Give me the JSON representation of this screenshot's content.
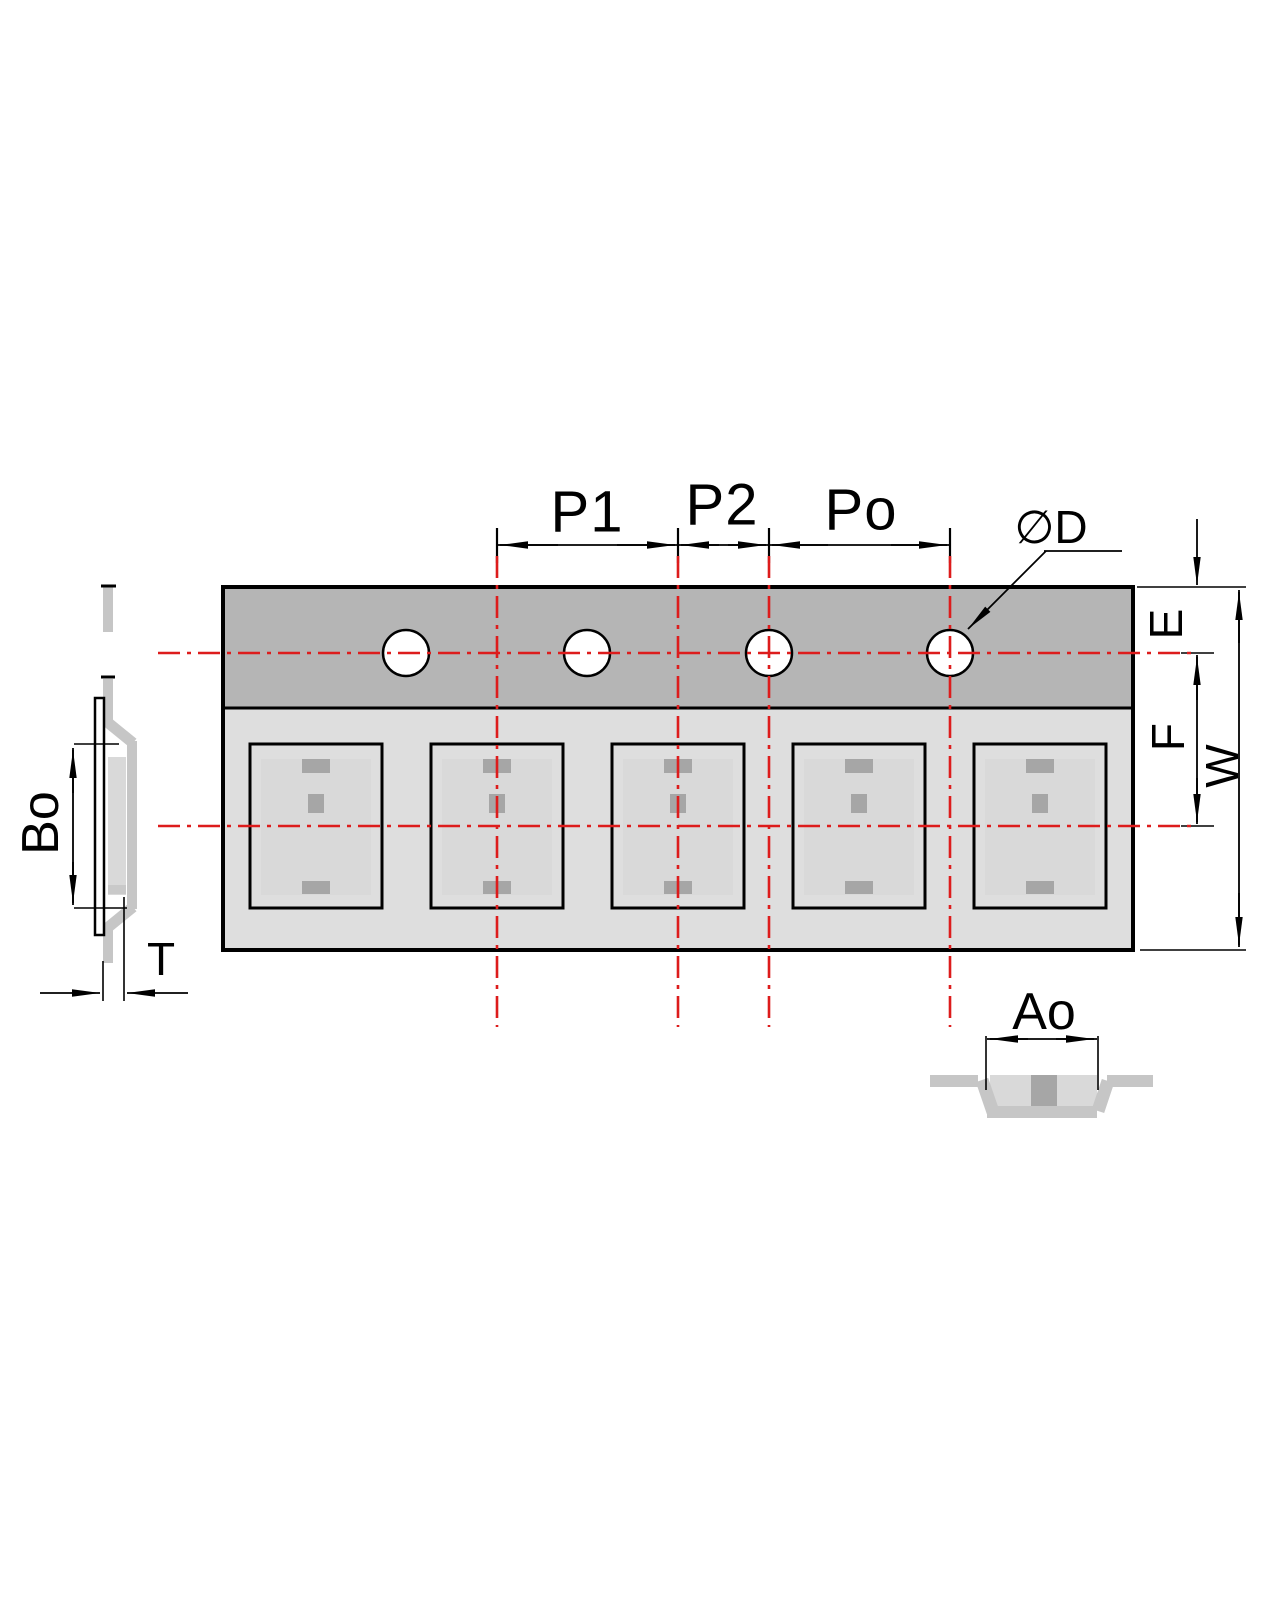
{
  "labels": {
    "p1": "P1",
    "p2": "P2",
    "po": "Po",
    "diameter_d": "∅D",
    "e": "E",
    "f": "F",
    "w": "W",
    "bo": "Bo",
    "t": "T",
    "ao": "Ao"
  },
  "counts": {
    "pockets": 5,
    "sprocket_holes": 4
  },
  "colors": {
    "centerline_red": "#dd1c1c",
    "sprocket_band_gray": "#b5b5b5",
    "pocket_band_gray": "#dedede",
    "pocket_inner_white": "#ffffff",
    "component_gray": "#d9d9d9",
    "mark_gray": "#a6a6a6",
    "profile_gray": "#c6c6c6",
    "line_black": "#000000",
    "background": "#ffffff"
  }
}
